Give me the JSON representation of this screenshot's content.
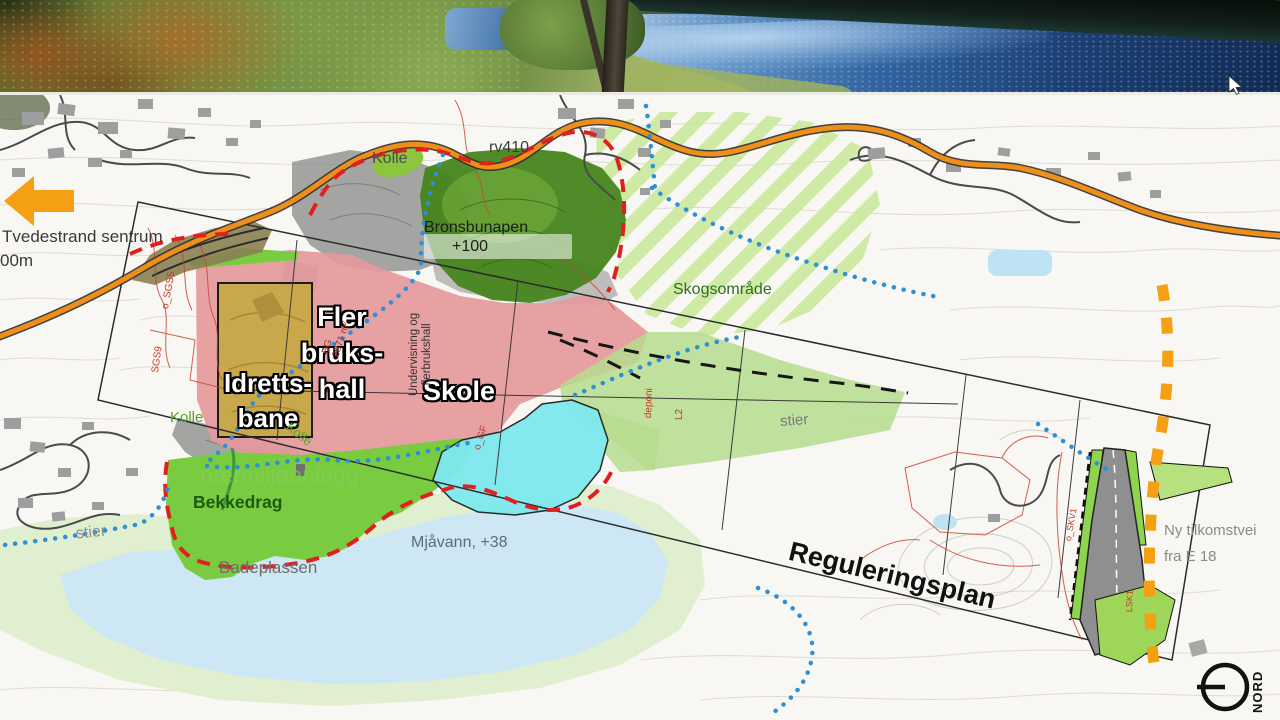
{
  "photo": {
    "icons": {
      "cursor_pointer": "arrow-cursor",
      "description_left": "forest-foliage",
      "description_right": "lake-water"
    }
  },
  "map": {
    "labels": {
      "tvedestrand": "Tvedestrand sentrum",
      "distance": "00m",
      "kolle_top": "Kolle",
      "rv410": "rv410",
      "bronsbunapen": "Bronsbunapen",
      "elevation": "+100",
      "skogsomrade": "Skogsområde",
      "flerbrukshall_l1": "Fler",
      "flerbrukshall_l2": "bruks-",
      "flerbrukshall_l3": "hall",
      "idrettsbane_l1": "Idretts-",
      "idrettsbane_l2": "bane",
      "skole": "Skole",
      "undervisning_l1": "Undervisning og",
      "undervisning_l2": "flerbrukshall",
      "bg_code_l1": "BG",
      "bg_code_l2": "2871 m²",
      "kolle_bottom": "Kolle",
      "kolle_slope": "Kolle",
      "naermiljo": "nærmiljøanlegg",
      "bekkedrag": "Bekkedrag",
      "stier_left": "stier",
      "stier_right": "stier",
      "badeplassen": "Badeplassen",
      "mjavann": "Mjåvann, +38",
      "reguleringsplan": "Reguleringsplan",
      "ny_tilkomstvei_l1": "Ny tilkomstvei",
      "ny_tilkomstvei_l2": "fra E 18",
      "nord": "NORD",
      "code_sgs9": "SGS9",
      "code_osgs": "o_SGS5",
      "code_ogf": "o_GF",
      "code_deponi": "deponi",
      "code_l2": "L2",
      "code_oskv": "o_SKV1",
      "code_lsk": "LSK1"
    },
    "colors": {
      "road_orange": "#ef8f1a",
      "boundary_red": "#e01f1f",
      "trail_blue": "#2d8fd6",
      "zone_pink": "#e5999c",
      "zone_green_bright": "#79cb40",
      "zone_green_light": "#b6dc8e",
      "zone_cyan": "#7de9ee",
      "zone_tan": "#c9a84c",
      "lake_blue": "#cde7f4",
      "lake_fringe": "#e0efcf",
      "stripe_green": "#c6e897",
      "dash_orange": "#f59f12",
      "hill_green_dark": "#47851f",
      "corridor_green": "#8ed44e",
      "gray_hill": "#8e8e8e"
    }
  }
}
